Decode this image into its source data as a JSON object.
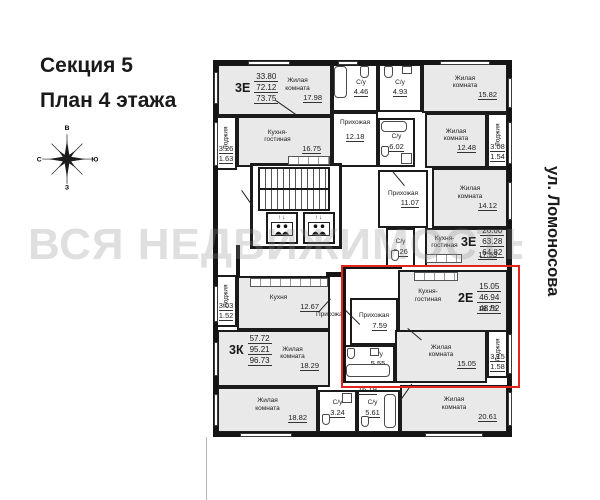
{
  "title": {
    "line1": "Секция 5",
    "line2": "План 4 этажа"
  },
  "watermark": "ВСЯ НЕДВИЖИМОСТЬ",
  "street": "ул. Ломоносова",
  "compass": {
    "top": "В",
    "right": "Ю",
    "bottom": "З",
    "left": "С"
  },
  "colors": {
    "highlight": "#e3241d",
    "wall": "#141414",
    "room_fill": "#e9e9e9"
  },
  "elevator": {
    "arrows": "↑↓"
  },
  "apartments": [
    {
      "type": "3Е",
      "living": "33.80",
      "area": "72.12",
      "total": "73.75"
    },
    {
      "type": "3Е",
      "living": "26.60",
      "area": "63.28",
      "total": "64.82"
    },
    {
      "type": "2Е",
      "living": "15.05",
      "area": "46.94",
      "total": "48.52"
    },
    {
      "type": "3К",
      "living": "57.72",
      "area": "95.21",
      "total": "96.73"
    }
  ],
  "rooms": [
    {
      "label": "Жилая комната",
      "area": "17.98"
    },
    {
      "label": "С/у",
      "area": "4.46"
    },
    {
      "label": "С/у",
      "area": "4.93"
    },
    {
      "label": "Жилая комната",
      "area": "15.82"
    },
    {
      "label": "Прихожая",
      "area": "12.18"
    },
    {
      "label": "С/у",
      "area": "6.02"
    },
    {
      "label": "Кухня-гостиная",
      "area": "16.75"
    },
    {
      "label": "Лоджия",
      "area": "3.26",
      "area2": "1.63"
    },
    {
      "label": "Жилая комната",
      "area": "12.48"
    },
    {
      "label": "Лоджия",
      "area": "3.08",
      "area2": "1.54"
    },
    {
      "label": "Прихожая",
      "area": "11.07"
    },
    {
      "label": "Жилая комната",
      "area": "14.12"
    },
    {
      "label": "Кухня-гостиная",
      "area": "17.33"
    },
    {
      "label": "С/у",
      "area": "2.26"
    },
    {
      "label": "Кухня-гостиная",
      "area": "18.75"
    },
    {
      "label": "Прихожая",
      "area": "7.59"
    },
    {
      "label": "С/у",
      "area": "5.55"
    },
    {
      "label": "Жилая комната",
      "area": "15.05"
    },
    {
      "label": "Лоджия",
      "area": "3.15",
      "area2": "1.58"
    },
    {
      "label": "Кухня",
      "area": "12.67"
    },
    {
      "label": "Лоджия",
      "area": "3.03",
      "area2": "1.52"
    },
    {
      "label": "Прихожая",
      "area": "16.19"
    },
    {
      "label": "Жилая комната",
      "area": "18.29"
    },
    {
      "label": "Жилая комната",
      "area": "18.82"
    },
    {
      "label": "С/у",
      "area": "3.24"
    },
    {
      "label": "С/у",
      "area": "5.61"
    },
    {
      "label": "Жилая комната",
      "area": "20.61"
    }
  ]
}
